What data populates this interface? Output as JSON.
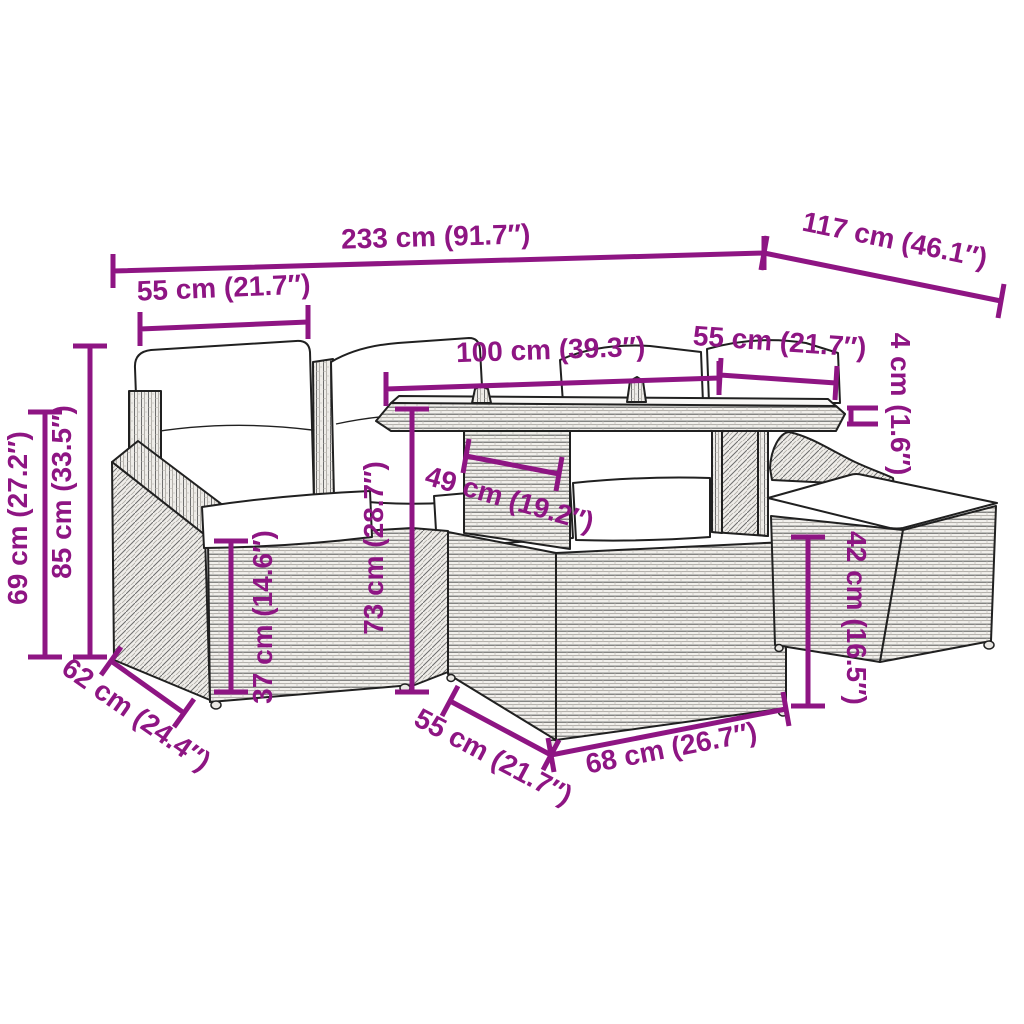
{
  "diagram": {
    "kind": "product-dimension-diagram",
    "subject": "poly rattan garden lounge set with glass-top table, corner sofa and footstool",
    "accent_color": "#8E1583",
    "outline_color": "#202020",
    "cushion_color": "#ffffff",
    "background_color": "#ffffff",
    "unit_system": "cm and inches"
  },
  "dimensions": {
    "overall_width": {
      "label": "233 cm (91.7″)",
      "cm": 233,
      "inches": 91.7
    },
    "overall_depth": {
      "label": "117 cm (46.1″)",
      "cm": 117,
      "inches": 46.1
    },
    "seat_width": {
      "label": "55 cm (21.7″)",
      "cm": 55,
      "inches": 21.7
    },
    "table_length": {
      "label": "100 cm (39.3″)",
      "cm": 100,
      "inches": 39.3
    },
    "table_depth": {
      "label": "55 cm (21.7″)",
      "cm": 55,
      "inches": 21.7
    },
    "tabletop_thickness": {
      "label": "4 cm (1.6″)",
      "cm": 4,
      "inches": 1.6
    },
    "armrest_height": {
      "label": "69 cm (27.2″)",
      "cm": 69,
      "inches": 27.2
    },
    "total_height": {
      "label": "85 cm (33.5″)",
      "cm": 85,
      "inches": 33.5
    },
    "seat_height": {
      "label": "37 cm (14.6″)",
      "cm": 37,
      "inches": 14.6
    },
    "table_height": {
      "label": "73 cm (28.7″)",
      "cm": 73,
      "inches": 28.7
    },
    "table_inner_width": {
      "label": "49 cm (19.2″)",
      "cm": 49,
      "inches": 19.2
    },
    "stool_height": {
      "label": "42 cm (16.5″)",
      "cm": 42,
      "inches": 16.5
    },
    "seat_depth": {
      "label": "62 cm (24.4″)",
      "cm": 62,
      "inches": 24.4
    },
    "table_base_depth": {
      "label": "55 cm (21.7″)",
      "cm": 55,
      "inches": 21.7
    },
    "table_base_width": {
      "label": "68 cm (26.7″)",
      "cm": 68,
      "inches": 26.7
    }
  }
}
